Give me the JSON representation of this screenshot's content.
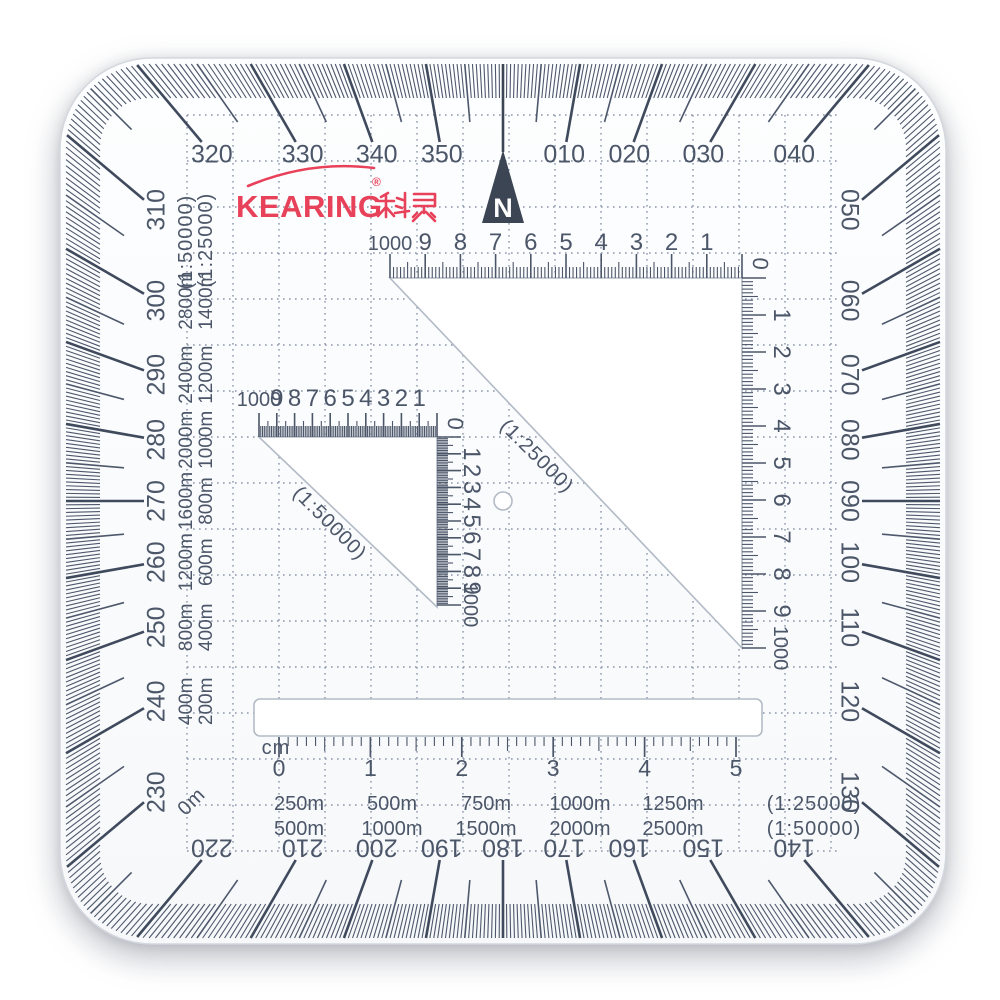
{
  "brand": {
    "name": "KEARING",
    "reg": "®",
    "cn": "科灵"
  },
  "compass": {
    "letter": "N"
  },
  "degree_labels": [
    "010",
    "020",
    "030",
    "040",
    "050",
    "060",
    "070",
    "080",
    "090",
    "100",
    "110",
    "120",
    "130",
    "140",
    "150",
    "160",
    "170",
    "180",
    "190",
    "200",
    "210",
    "220",
    "230",
    "240",
    "250",
    "260",
    "270",
    "280",
    "290",
    "300",
    "310",
    "320",
    "330",
    "340",
    "350"
  ],
  "romers": {
    "scale_25000": {
      "caption": "(1:25000)",
      "top_numbers": [
        "1000",
        "9",
        "8",
        "7",
        "6",
        "5",
        "4",
        "3",
        "2",
        "1"
      ],
      "right_numbers": [
        "1",
        "2",
        "3",
        "4",
        "5",
        "6",
        "7",
        "8",
        "9",
        "1000"
      ],
      "zero": "0"
    },
    "scale_50000": {
      "caption": "(1:50000)",
      "top_numbers": [
        "1000",
        "9",
        "8",
        "7",
        "6",
        "5",
        "4",
        "3",
        "2",
        "1"
      ],
      "right_numbers": [
        "1",
        "2",
        "3",
        "4",
        "5",
        "6",
        "7",
        "8",
        "9",
        "1000"
      ],
      "zero": "0"
    }
  },
  "left_columns": {
    "col_25000": {
      "header": "(1:25000)",
      "values": [
        "1400m",
        "1200m",
        "1000m",
        "800m",
        "600m",
        "400m",
        "200m"
      ]
    },
    "col_50000": {
      "header": "(1:50000)",
      "values": [
        "2800m",
        "2400m",
        "2000m",
        "1600m",
        "1200m",
        "800m",
        "400m"
      ]
    },
    "zero_label": "0m"
  },
  "cm_ruler": {
    "unit": "cm",
    "numbers": [
      "0",
      "1",
      "2",
      "3",
      "4",
      "5"
    ]
  },
  "scale_table": {
    "rows": [
      {
        "values": [
          "250m",
          "500m",
          "750m",
          "1000m",
          "1250m"
        ],
        "caption": "(1:25000)"
      },
      {
        "values": [
          "500m",
          "1000m",
          "1500m",
          "2000m",
          "2500m"
        ],
        "caption": "(1:50000)"
      }
    ]
  },
  "colors": {
    "ink": "#4c5669",
    "grid": "#8b96ab",
    "brand_red": "#e8415a",
    "compass_fill": "#3c4554"
  }
}
